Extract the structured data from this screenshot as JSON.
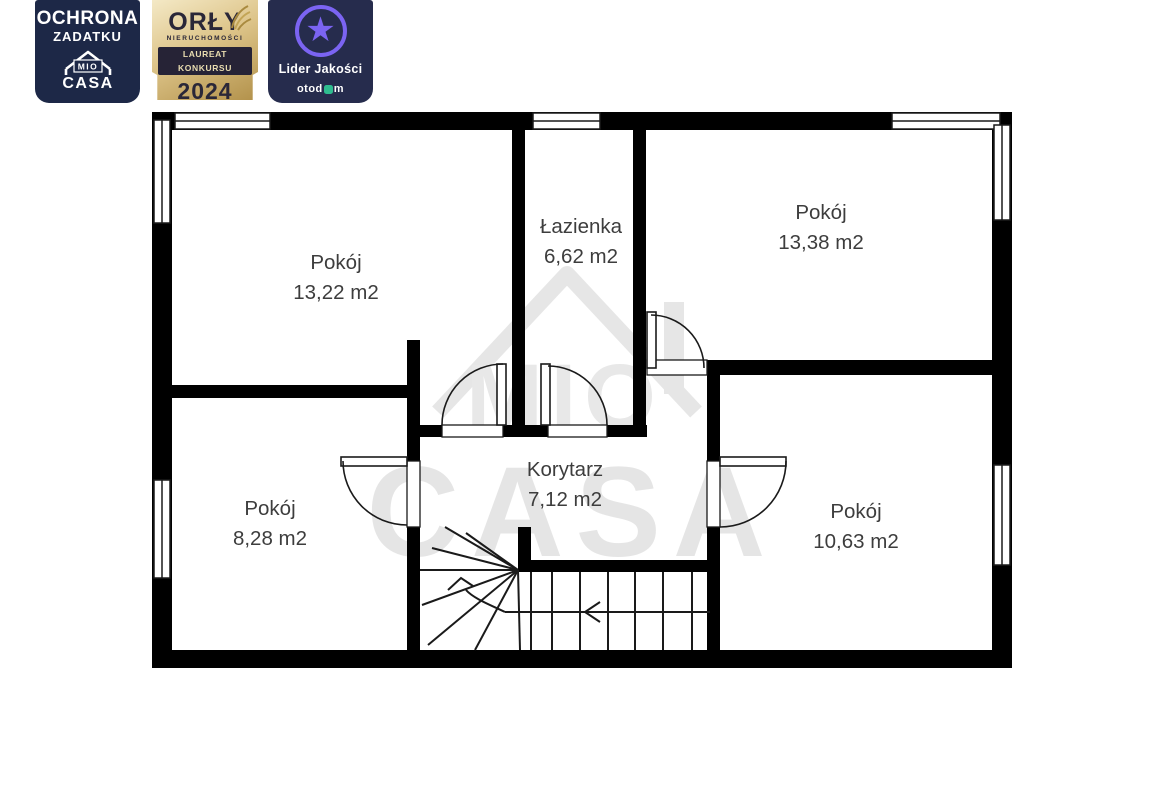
{
  "badges": {
    "protection": {
      "title_line1": "OCHRONA",
      "title_line2": "ZADATKU",
      "logo_mio": "MIO",
      "logo_casa": "CASA",
      "bg_color": "#1d2847"
    },
    "award": {
      "title": "ORŁY",
      "subtitle": "NIERUCHOMOŚCI",
      "ribbon": "LAUREAT KONKURSU",
      "year": "2024",
      "text_color": "#2a2738",
      "gold_color": "#d9c183"
    },
    "quality": {
      "title": "Lider Jakości",
      "brand_prefix": "otod",
      "brand_suffix": "m",
      "star_color": "#7b64f2",
      "green_color": "#2fbd8f",
      "bg_color": "#262c4d"
    }
  },
  "floorplan": {
    "rooms": [
      {
        "name": "Pokój",
        "area": "13,22 m2"
      },
      {
        "name": "Łazienka",
        "area": "6,62 m2"
      },
      {
        "name": "Pokój",
        "area": "13,38 m2"
      },
      {
        "name": "Pokój",
        "area": "8,28 m2"
      },
      {
        "name": "Korytarz",
        "area": "7,12 m2"
      },
      {
        "name": "Pokój",
        "area": "10,63 m2"
      }
    ],
    "watermark": {
      "mio": "MIO",
      "casa": "CASA"
    },
    "wall_color": "#000000",
    "label_color": "#3d3d3d"
  }
}
